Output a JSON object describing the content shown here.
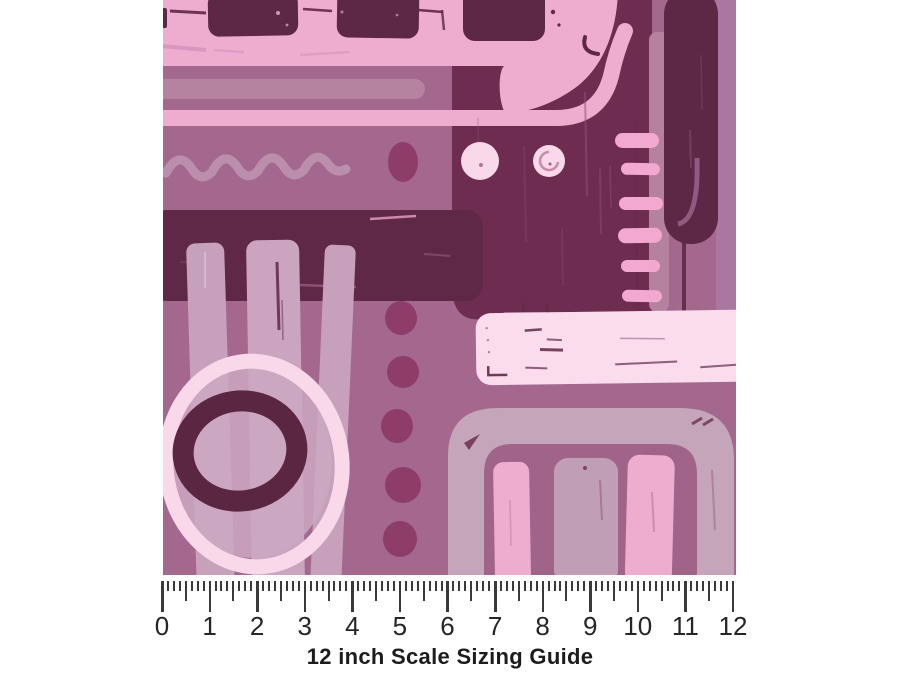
{
  "title": "12 inch Scale Sizing Guide",
  "ruler": {
    "numbers": [
      "0",
      "1",
      "2",
      "3",
      "4",
      "5",
      "6",
      "7",
      "8",
      "9",
      "10",
      "11",
      "12"
    ],
    "inches": 12,
    "divisions_per_inch": 8
  },
  "palette": {
    "page": "#ffffff",
    "mauve": "#a4688f",
    "mauve2": "#aa77a0",
    "pink": "#eeadce",
    "blush": "#f8d8e9",
    "blush_soft": "#fadcec",
    "plum_deep": "#5d2845",
    "plum_quad": "#6e2d50",
    "plum_band": "#5e2846",
    "plum_ring": "#5a2642",
    "berry": "#8e3c68",
    "lilac": "#b5829f",
    "lilac2": "#bb8fab",
    "bar_lilac": "#c7a0bc",
    "bar_lilac2": "#cba4c0",
    "rose_band": "#b4819f",
    "dash_pink": "#f2a8cf",
    "arch_frame": "#c4a5b9",
    "arch_inner": "#a0648a",
    "arch_midbar": "#c09fb6",
    "disc": "#cda8c2",
    "scratch_dark": "#8d5078",
    "scratch_pink": "#d893c0",
    "tick": "#3a3a3a",
    "number": "#262626",
    "title_ink": "#1c1c1c"
  }
}
